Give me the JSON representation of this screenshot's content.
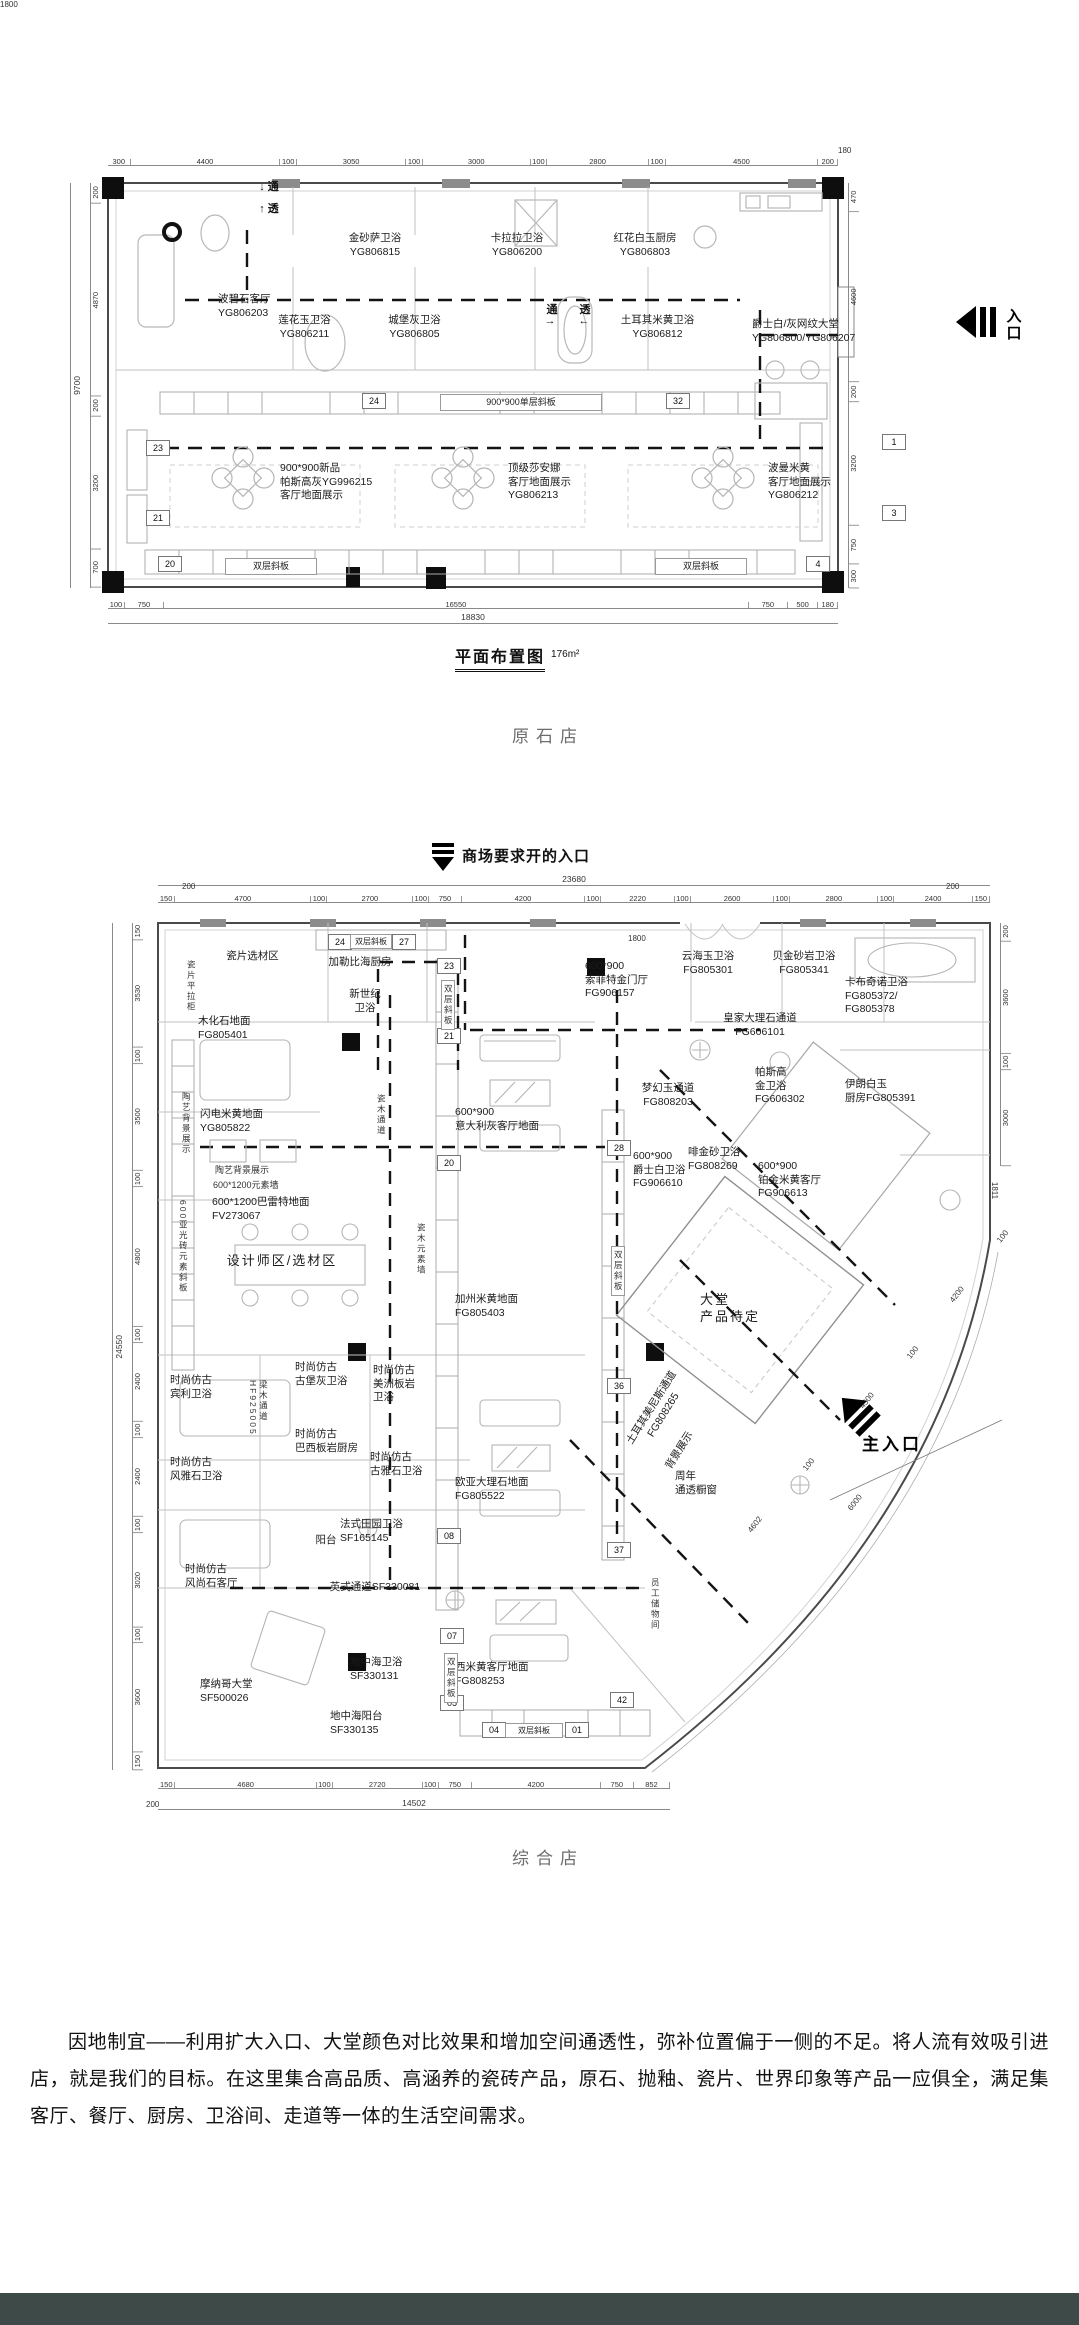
{
  "page": {
    "background": "#ffffff",
    "footer_color": "#3d4a47"
  },
  "plan1": {
    "caption": "原石店",
    "title": "平面布置图",
    "title_area": "176m²",
    "entry_icon": "entry-arrow-left-icon",
    "dims": {
      "overall_bottom": "18830",
      "overall_left": "9700",
      "top": [
        {
          "t": "300",
          "f": 300
        },
        {
          "t": "4400",
          "f": 4400
        },
        {
          "t": "100",
          "f": 100
        },
        {
          "t": "3050",
          "f": 3050
        },
        {
          "t": "100",
          "f": 100
        },
        {
          "t": "3000",
          "f": 3000
        },
        {
          "t": "100",
          "f": 100
        },
        {
          "t": "2800",
          "f": 2800
        },
        {
          "t": "100",
          "f": 100
        },
        {
          "t": "4500",
          "f": 4500
        },
        {
          "t": "200",
          "f": 200
        }
      ],
      "bottom": [
        {
          "t": "100",
          "f": 100
        },
        {
          "t": "750",
          "f": 750
        },
        {
          "t": "16550",
          "f": 16550
        },
        {
          "t": "750",
          "f": 750
        },
        {
          "t": "500",
          "f": 500
        },
        {
          "t": "180",
          "f": 180
        }
      ],
      "left": [
        {
          "t": "200",
          "f": 200
        },
        {
          "t": "4870",
          "f": 4870
        },
        {
          "t": "200",
          "f": 200
        },
        {
          "t": "3200",
          "f": 3200
        },
        {
          "t": "700",
          "f": 700
        }
      ],
      "right": [
        {
          "t": "470",
          "f": 470
        },
        {
          "t": "4600",
          "f": 4600
        },
        {
          "t": "200",
          "f": 200
        },
        {
          "t": "3200",
          "f": 3200
        },
        {
          "t": "750",
          "f": 750
        },
        {
          "t": "300",
          "f": 300
        }
      ]
    },
    "labels": [
      {
        "t": "金砂萨卫浴\nYG806815",
        "x": 320,
        "y": 232,
        "w": 110,
        "cls": "room"
      },
      {
        "t": "卡拉拉卫浴\nYG806200",
        "x": 462,
        "y": 232,
        "w": 110,
        "cls": "room"
      },
      {
        "t": "红花白玉厨房\nYG806803",
        "x": 585,
        "y": 232,
        "w": 120,
        "cls": "room"
      },
      {
        "t": "波碧石客厅\nYG806203",
        "x": 218,
        "y": 293,
        "w": 100,
        "cls": "room",
        "align": "left"
      },
      {
        "t": "莲花玉卫浴\nYG806211",
        "x": 252,
        "y": 314,
        "w": 105,
        "cls": "room"
      },
      {
        "t": "城堡灰卫浴\nYG806805",
        "x": 362,
        "y": 314,
        "w": 105,
        "cls": "room"
      },
      {
        "t": "土耳其米黄卫浴\nYG806812",
        "x": 590,
        "y": 314,
        "w": 135,
        "cls": "room"
      },
      {
        "t": "爵士白/灰网纹大堂\nYG806800/YG806207",
        "x": 752,
        "y": 318,
        "w": 122,
        "cls": "room",
        "align": "left"
      },
      {
        "t": "900*900新品\n帕斯高灰YG996215\n客厅地面展示",
        "x": 280,
        "y": 462,
        "w": 135,
        "cls": "room",
        "align": "left"
      },
      {
        "t": "顶级莎安娜\n客厅地面展示\nYG806213",
        "x": 508,
        "y": 462,
        "w": 110,
        "cls": "room",
        "align": "left"
      },
      {
        "t": "波曼米黄\n客厅地面展示\nYG806212",
        "x": 768,
        "y": 462,
        "w": 105,
        "cls": "room",
        "align": "left"
      },
      {
        "t": "900*900单层斜板",
        "x": 440,
        "y": 394,
        "w": 160,
        "cls": "band"
      },
      {
        "t": "双层斜板",
        "x": 225,
        "y": 558,
        "w": 90,
        "cls": "band"
      },
      {
        "t": "双层斜板",
        "x": 655,
        "y": 558,
        "w": 90,
        "cls": "band"
      },
      {
        "t": "↓ 通",
        "x": 243,
        "y": 178,
        "w": 52,
        "cls": "flow"
      },
      {
        "t": "↑ 透",
        "x": 243,
        "y": 200,
        "w": 52,
        "cls": "flow"
      },
      {
        "t": "通",
        "x": 543,
        "y": 301,
        "w": 18,
        "cls": "flow"
      },
      {
        "t": "透",
        "x": 576,
        "y": 301,
        "w": 18,
        "cls": "flow"
      },
      {
        "t": "→",
        "x": 540,
        "y": 315,
        "w": 20,
        "cls": "flow"
      },
      {
        "t": "←",
        "x": 574,
        "y": 315,
        "w": 20,
        "cls": "flow"
      },
      {
        "t": "入\n口",
        "x": 1002,
        "y": 308,
        "w": 24,
        "cls": "entry-label"
      },
      {
        "t": "180",
        "x": 838,
        "y": 146,
        "cls": "dimfree"
      },
      {
        "t": "1800",
        "x": 0,
        "y": 0,
        "w": 0,
        "cls": "dimfree hidden"
      }
    ],
    "tags": [
      {
        "t": "24",
        "x": 362,
        "y": 393
      },
      {
        "t": "32",
        "x": 666,
        "y": 393
      },
      {
        "t": "23",
        "x": 146,
        "y": 440
      },
      {
        "t": "21",
        "x": 146,
        "y": 510
      },
      {
        "t": "20",
        "x": 158,
        "y": 556
      },
      {
        "t": "4",
        "x": 806,
        "y": 556
      },
      {
        "t": "1",
        "x": 882,
        "y": 434
      },
      {
        "t": "3",
        "x": 882,
        "y": 505
      }
    ]
  },
  "plan2": {
    "caption": "综合店",
    "note": "商场要求开的入口",
    "entry_icon": "entry-arrow-down-icon",
    "main_entry_icon": "entry-arrow-upleft-icon",
    "dims": {
      "overall_top": "23680",
      "overall_left": "24550",
      "overall_bottom": "14502",
      "top": [
        {
          "t": "150",
          "f": 150
        },
        {
          "t": "4700",
          "f": 4700
        },
        {
          "t": "100",
          "f": 100
        },
        {
          "t": "2700",
          "f": 2700
        },
        {
          "t": "100",
          "f": 100
        },
        {
          "t": "750",
          "f": 750
        },
        {
          "t": "4200",
          "f": 4200
        },
        {
          "t": "100",
          "f": 100
        },
        {
          "t": "2220",
          "f": 2220
        },
        {
          "t": "100",
          "f": 100
        },
        {
          "t": "2600",
          "f": 2600
        },
        {
          "t": "100",
          "f": 100
        },
        {
          "t": "2800",
          "f": 2800
        },
        {
          "t": "100",
          "f": 100
        },
        {
          "t": "2400",
          "f": 2400
        },
        {
          "t": "150",
          "f": 150
        }
      ],
      "left": [
        {
          "t": "150",
          "f": 150
        },
        {
          "t": "3530",
          "f": 3530
        },
        {
          "t": "100",
          "f": 100
        },
        {
          "t": "3500",
          "f": 3500
        },
        {
          "t": "100",
          "f": 100
        },
        {
          "t": "4800",
          "f": 4800
        },
        {
          "t": "100",
          "f": 100
        },
        {
          "t": "2400",
          "f": 2400
        },
        {
          "t": "100",
          "f": 100
        },
        {
          "t": "2400",
          "f": 2400
        },
        {
          "t": "100",
          "f": 100
        },
        {
          "t": "3020",
          "f": 3020
        },
        {
          "t": "100",
          "f": 100
        },
        {
          "t": "3600",
          "f": 3600
        },
        {
          "t": "150",
          "f": 150
        }
      ],
      "right": [
        {
          "t": "200",
          "f": 200
        },
        {
          "t": "3600",
          "f": 3600
        },
        {
          "t": "100",
          "f": 100
        },
        {
          "t": "3000",
          "f": 3000
        }
      ],
      "bottom": [
        {
          "t": "150",
          "f": 150
        },
        {
          "t": "4680",
          "f": 4680
        },
        {
          "t": "100",
          "f": 100
        },
        {
          "t": "2720",
          "f": 2720
        },
        {
          "t": "100",
          "f": 100
        },
        {
          "t": "750",
          "f": 750
        },
        {
          "t": "4200",
          "f": 4200
        },
        {
          "t": "750",
          "f": 750
        },
        {
          "t": "852",
          "f": 852
        }
      ]
    },
    "labels": [
      {
        "t": "瓷片选材区",
        "x": 205,
        "y": 950,
        "w": 95,
        "cls": "room"
      },
      {
        "t": "瓷片平拉柜",
        "x": 186,
        "y": 960,
        "cls": "vtag"
      },
      {
        "t": "加勒比海厨房",
        "x": 308,
        "y": 956,
        "w": 104,
        "cls": "room"
      },
      {
        "t": "新世纪\n卫浴",
        "x": 330,
        "y": 988,
        "w": 70,
        "cls": "room"
      },
      {
        "t": "木化石地面\nFG805401",
        "x": 198,
        "y": 1015,
        "w": 90,
        "cls": "room",
        "align": "left"
      },
      {
        "t": "600*900\n索菲特金门厅\nFG906157",
        "x": 585,
        "y": 960,
        "w": 95,
        "cls": "room",
        "align": "left"
      },
      {
        "t": "云海玉卫浴\nFG805301",
        "x": 662,
        "y": 950,
        "w": 92,
        "cls": "room"
      },
      {
        "t": "贝金砂岩卫浴\nFG805341",
        "x": 752,
        "y": 950,
        "w": 104,
        "cls": "room"
      },
      {
        "t": "卡布奇诺卫浴\nFG805372/\nFG805378",
        "x": 845,
        "y": 976,
        "w": 95,
        "cls": "room",
        "align": "left"
      },
      {
        "t": "皇家大理石通道\nFG606101",
        "x": 698,
        "y": 1012,
        "w": 124,
        "cls": "room"
      },
      {
        "t": "梦幻玉通道\nFG808203",
        "x": 618,
        "y": 1082,
        "w": 100,
        "cls": "room"
      },
      {
        "t": "帕斯高\n金卫浴\nFG606302",
        "x": 755,
        "y": 1066,
        "w": 78,
        "cls": "room",
        "align": "left"
      },
      {
        "t": "伊朗白玉\n厨房FG805391",
        "x": 845,
        "y": 1078,
        "w": 96,
        "cls": "room",
        "align": "left"
      },
      {
        "t": "闪电米黄地面\nYG805822",
        "x": 200,
        "y": 1108,
        "w": 100,
        "cls": "room",
        "align": "left"
      },
      {
        "t": "陶艺背景展示",
        "x": 181,
        "y": 1092,
        "cls": "vtag"
      },
      {
        "t": "陶艺背景展示",
        "x": 215,
        "y": 1163,
        "w": 90,
        "cls": "small"
      },
      {
        "t": "600*1200元素墙",
        "x": 213,
        "y": 1178,
        "w": 110,
        "cls": "small",
        "align": "left"
      },
      {
        "t": "600*1200巴雷特地面\nFV273067",
        "x": 212,
        "y": 1196,
        "w": 140,
        "cls": "room",
        "align": "left"
      },
      {
        "t": "设计师区/选材区",
        "x": 222,
        "y": 1253,
        "w": 120,
        "cls": "room big"
      },
      {
        "t": "瓷木通道",
        "x": 376,
        "y": 1094,
        "cls": "vtag"
      },
      {
        "t": "600*900\n意大利灰客厅地面",
        "x": 455,
        "y": 1106,
        "w": 132,
        "cls": "room",
        "align": "left"
      },
      {
        "t": "加州米黄地面\nFG805403",
        "x": 455,
        "y": 1293,
        "w": 110,
        "cls": "room",
        "align": "left"
      },
      {
        "t": "瓷木元素墙",
        "x": 416,
        "y": 1223,
        "cls": "vtag"
      },
      {
        "t": "600亚光砖元素斜板",
        "x": 178,
        "y": 1200,
        "cls": "vtag"
      },
      {
        "t": "600*900\n爵士白卫浴\nFG906610",
        "x": 633,
        "y": 1150,
        "w": 92,
        "cls": "room",
        "align": "left"
      },
      {
        "t": "啡金砂卫浴\nFG808269",
        "x": 688,
        "y": 1146,
        "w": 90,
        "cls": "room",
        "align": "left"
      },
      {
        "t": "600*900\n铂金米黄客厅\nFG906613",
        "x": 758,
        "y": 1160,
        "w": 102,
        "cls": "room",
        "align": "left"
      },
      {
        "t": "大堂\n产品待定",
        "x": 700,
        "y": 1292,
        "w": 86,
        "cls": "room big",
        "align": "left"
      },
      {
        "t": "时尚仿古\n宾利卫浴",
        "x": 170,
        "y": 1374,
        "w": 72,
        "cls": "room",
        "align": "left"
      },
      {
        "t": "梁木通道\nHF925005",
        "x": 248,
        "y": 1380,
        "cls": "vtag"
      },
      {
        "t": "时尚仿古\n古堡灰卫浴",
        "x": 295,
        "y": 1361,
        "w": 88,
        "cls": "room",
        "align": "left"
      },
      {
        "t": "时尚仿古\n美洲板岩\n卫浴",
        "x": 373,
        "y": 1364,
        "w": 72,
        "cls": "room",
        "align": "left"
      },
      {
        "t": "时尚仿古\n巴西板岩厨房",
        "x": 295,
        "y": 1428,
        "w": 102,
        "cls": "room",
        "align": "left"
      },
      {
        "t": "时尚仿古\n古雅石卫浴",
        "x": 370,
        "y": 1451,
        "w": 88,
        "cls": "room",
        "align": "left"
      },
      {
        "t": "时尚仿古\n风雅石卫浴",
        "x": 170,
        "y": 1456,
        "w": 88,
        "cls": "room",
        "align": "left"
      },
      {
        "t": "欧亚大理石地面\nFG805522",
        "x": 455,
        "y": 1476,
        "w": 112,
        "cls": "room",
        "align": "left"
      },
      {
        "t": "法式田园卫浴\nSF165145",
        "x": 340,
        "y": 1518,
        "w": 100,
        "cls": "room",
        "align": "left"
      },
      {
        "t": "阳台",
        "x": 308,
        "y": 1534,
        "w": 36,
        "cls": "room"
      },
      {
        "t": "时尚仿古\n风尚石客厅",
        "x": 185,
        "y": 1563,
        "w": 88,
        "cls": "room",
        "align": "left"
      },
      {
        "t": "英式通道SF330081",
        "x": 308,
        "y": 1581,
        "w": 134,
        "cls": "room"
      },
      {
        "t": "摩纳哥大堂\nSF500026",
        "x": 200,
        "y": 1678,
        "w": 92,
        "cls": "room",
        "align": "left"
      },
      {
        "t": "地中海卫浴\nSF330131",
        "x": 350,
        "y": 1656,
        "w": 92,
        "cls": "room",
        "align": "left"
      },
      {
        "t": "地中海阳台\nSF330135",
        "x": 330,
        "y": 1710,
        "w": 92,
        "cls": "room",
        "align": "left"
      },
      {
        "t": "西米黄客厅地面\nFG808253",
        "x": 455,
        "y": 1661,
        "w": 112,
        "cls": "room",
        "align": "left"
      },
      {
        "t": "土耳其美尼斯通道\nFG808265",
        "x": 596,
        "y": 1398,
        "w": 124,
        "cls": "room",
        "rot": -58
      },
      {
        "t": "背景展示",
        "x": 648,
        "y": 1444,
        "w": 64,
        "cls": "room",
        "rot": -58
      },
      {
        "t": "周年\n通透橱窗",
        "x": 675,
        "y": 1470,
        "w": 72,
        "cls": "room",
        "align": "left"
      },
      {
        "t": "员工储物间",
        "x": 650,
        "y": 1578,
        "cls": "vtag"
      },
      {
        "t": "主入口",
        "x": 862,
        "y": 1430,
        "w": 92,
        "cls": "entry-main"
      },
      {
        "t": "200",
        "x": 182,
        "y": 882,
        "cls": "dimfree"
      },
      {
        "t": "200",
        "x": 946,
        "y": 882,
        "cls": "dimfree"
      },
      {
        "t": "1800",
        "x": 628,
        "y": 934,
        "cls": "dimfree"
      },
      {
        "t": "200",
        "x": 146,
        "y": 1800,
        "cls": "dimfree"
      },
      {
        "t": "1811",
        "x": 986,
        "y": 1186,
        "cls": "dimfree",
        "rot": 90
      },
      {
        "t": "100",
        "x": 996,
        "y": 1232,
        "cls": "dimfree",
        "rot": -52
      },
      {
        "t": "4200",
        "x": 948,
        "y": 1290,
        "cls": "dimfree",
        "rot": -52
      },
      {
        "t": "100",
        "x": 906,
        "y": 1348,
        "cls": "dimfree",
        "rot": -52
      },
      {
        "t": "4500",
        "x": 858,
        "y": 1396,
        "cls": "dimfree",
        "rot": -52
      },
      {
        "t": "100",
        "x": 802,
        "y": 1460,
        "cls": "dimfree",
        "rot": -52
      },
      {
        "t": "6000",
        "x": 846,
        "y": 1498,
        "cls": "dimfree",
        "rot": -52
      },
      {
        "t": "4602",
        "x": 746,
        "y": 1520,
        "cls": "dimfree",
        "rot": -52
      }
    ],
    "tags": [
      {
        "t": "24",
        "x": 328,
        "y": 934
      },
      {
        "t": "27",
        "x": 392,
        "y": 934
      },
      {
        "t": "双层斜板",
        "x": 350,
        "y": 934,
        "w": 40,
        "cls": "band-sm"
      },
      {
        "t": "23",
        "x": 437,
        "y": 958
      },
      {
        "t": "21",
        "x": 437,
        "y": 1028
      },
      {
        "t": "双层斜板",
        "x": 441,
        "y": 980,
        "cls": "vtag vbox"
      },
      {
        "t": "20",
        "x": 437,
        "y": 1155
      },
      {
        "t": "28",
        "x": 607,
        "y": 1140
      },
      {
        "t": "36",
        "x": 607,
        "y": 1378
      },
      {
        "t": "双层斜板",
        "x": 611,
        "y": 1246,
        "cls": "vtag vbox"
      },
      {
        "t": "08",
        "x": 437,
        "y": 1528
      },
      {
        "t": "07",
        "x": 440,
        "y": 1628
      },
      {
        "t": "05",
        "x": 440,
        "y": 1695
      },
      {
        "t": "双层斜板",
        "x": 444,
        "y": 1653,
        "cls": "vtag vbox"
      },
      {
        "t": "37",
        "x": 607,
        "y": 1542
      },
      {
        "t": "42",
        "x": 610,
        "y": 1692
      },
      {
        "t": "04",
        "x": 482,
        "y": 1722
      },
      {
        "t": "01",
        "x": 565,
        "y": 1722
      },
      {
        "t": "双层斜板",
        "x": 505,
        "y": 1723,
        "w": 56,
        "cls": "band-sm"
      }
    ]
  },
  "paragraph": {
    "text": "因地制宜——利用扩大入口、大堂颜色对比效果和增加空间通透性，弥补位置偏于一侧的不足。将人流有效吸引进店，就是我们的目标。在这里集合高品质、高涵养的瓷砖产品，原石、抛釉、瓷片、世界印象等产品一应俱全，满足集客厅、餐厅、厨房、卫浴间、走道等一体的生活空间需求。"
  }
}
